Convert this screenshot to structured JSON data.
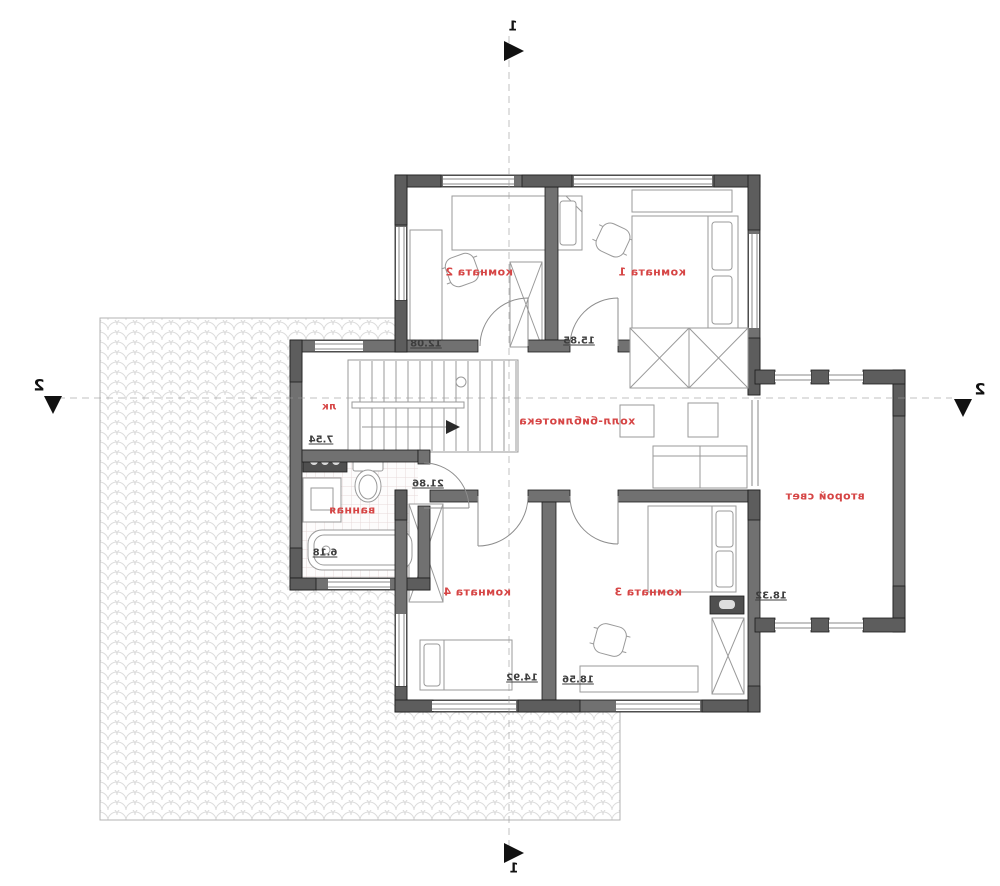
{
  "plan": {
    "type": "architectural-floor-plan",
    "mirrored": true,
    "rooms": [
      {
        "id": "room2",
        "label": "комната 2",
        "area": "12.08"
      },
      {
        "id": "room1",
        "label": "комната 1",
        "area": "15.85"
      },
      {
        "id": "hall",
        "label": "холл-библиотека",
        "area": "21.86"
      },
      {
        "id": "stair",
        "label": "лк",
        "area": "7.54"
      },
      {
        "id": "bath",
        "label": "ванная",
        "area": "6.18"
      },
      {
        "id": "room4",
        "label": "комната 4",
        "area": "14.92"
      },
      {
        "id": "room3",
        "label": "комната 3",
        "area": "18.56"
      },
      {
        "id": "secondlight",
        "label": "второй свет",
        "area": "18.32"
      }
    ],
    "markers": {
      "axis1": "1",
      "axis2": "2"
    },
    "colors": {
      "wall": "#717171",
      "wall_dark": "#5d5d5d",
      "room_label": "#d64545",
      "dimension_text": "#3d3d3d",
      "hatch_line": "#dcdcdc",
      "furniture_line": "#9a9a9a",
      "axis_line": "#9a9a9a",
      "marker": "#111111"
    }
  }
}
